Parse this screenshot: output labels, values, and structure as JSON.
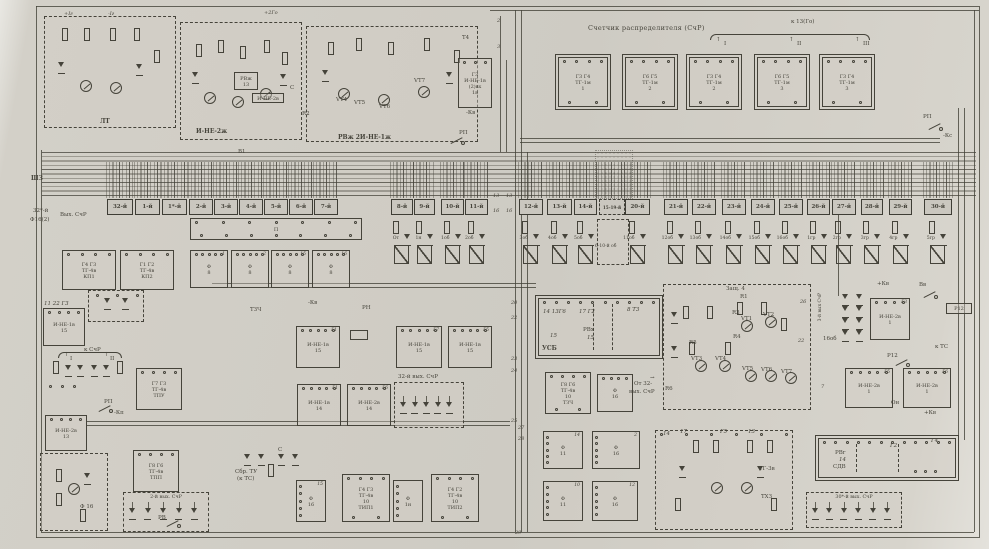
{
  "colors": {
    "paper": "#d0cdc5",
    "ink": "#45433a",
    "cell_fill": "#cac7bf"
  },
  "header": {
    "title": "Счетчик распределителя (СчР)",
    "to13": "к 13(Го)",
    "arrows": [
      "I",
      "II",
      "III"
    ]
  },
  "bus": {
    "label": "ШЗ"
  },
  "tg_row": [
    {
      "top": "Г3 Г4",
      "mid": "ТГ-1м",
      "num": "1"
    },
    {
      "top": "Г6 Г5",
      "mid": "ТГ-1м",
      "num": "2"
    },
    {
      "top": "Г3 Г4",
      "mid": "ТГ-1м",
      "num": "2"
    },
    {
      "top": "Г6 Г5",
      "mid": "ТГ-1м",
      "num": "3"
    },
    {
      "top": "Г3 Г4",
      "mid": "ТГ-1м",
      "num": "3"
    }
  ],
  "cells": [
    [
      "32-й",
      107,
      26
    ],
    [
      "1-й",
      135,
      25
    ],
    [
      "1*-й",
      162,
      25
    ],
    [
      "2-й",
      189,
      24
    ],
    [
      "3-й",
      214,
      24
    ],
    [
      "4-й",
      239,
      24
    ],
    [
      "5-й",
      264,
      24
    ],
    [
      "6-й",
      289,
      24
    ],
    [
      "7-й",
      314,
      24
    ],
    [
      "8-й",
      391,
      22
    ],
    [
      "9-й",
      414,
      21
    ],
    [
      "10-й",
      441,
      23
    ],
    [
      "11-й",
      465,
      23
    ],
    [
      "12-й",
      519,
      24
    ],
    [
      "13-й",
      547,
      25
    ],
    [
      "14-й",
      574,
      23
    ],
    [
      "15-19-й",
      599,
      26,
      "dash"
    ],
    [
      "20-й",
      625,
      25
    ],
    [
      "21-й",
      664,
      24
    ],
    [
      "22-й",
      692,
      24
    ],
    [
      "23-й",
      722,
      24
    ],
    [
      "24-й",
      751,
      24
    ],
    [
      "25-й",
      779,
      24
    ],
    [
      "26-й",
      807,
      23
    ],
    [
      "27-й",
      832,
      24
    ],
    [
      "28-й",
      861,
      22
    ],
    [
      "29-й",
      889,
      23
    ],
    [
      "30-й",
      924,
      28
    ]
  ],
  "contacts": [
    "От",
    "1н",
    "1об",
    "2об",
    "3об",
    "4об",
    "5об",
    "11об",
    "12об",
    "13об",
    "14об",
    "15об",
    "16об",
    "1гр",
    "2гр",
    "3гр",
    "4гр",
    "5гр"
  ],
  "contact_gap_label": "6-10-й об",
  "blocks": [
    {
      "id": "lt",
      "x": 44,
      "y": 16,
      "w": 132,
      "h": 112,
      "st": "dd",
      "deco": "analog2"
    },
    {
      "id": "i-ne-2zh",
      "x": 180,
      "y": 22,
      "w": 122,
      "h": 118,
      "st": "d",
      "deco": "analog3"
    },
    {
      "id": "rvzh",
      "x": 306,
      "y": 26,
      "w": 172,
      "h": 116,
      "st": "d",
      "deco": "analog3b"
    },
    {
      "id": "rvzh-13",
      "x": 234,
      "y": 72,
      "w": 24,
      "h": 18,
      "st": "s",
      "lines": [
        "РВж",
        "13"
      ]
    },
    {
      "id": "i-ne-2v-sm",
      "x": 252,
      "y": 93,
      "w": 32,
      "h": 10,
      "st": "s",
      "lines": [
        "И-НЕ-2в"
      ]
    },
    {
      "id": "i-ne-1v-1v",
      "x": 458,
      "y": 58,
      "w": 34,
      "h": 50,
      "st": "s",
      "pt": 3,
      "lines": [
        "Г3",
        "И-НЕ-1в",
        "(2)вх",
        "1в"
      ]
    },
    {
      "id": "tg-1",
      "x": 558,
      "y": 57,
      "w": 50,
      "h": 50,
      "st": "s",
      "dbl": 1,
      "pt": 4,
      "pb": 2,
      "lines": [
        "Г3 Г4",
        "ТГ-1м",
        "1"
      ]
    },
    {
      "id": "tg-2",
      "x": 625,
      "y": 57,
      "w": 50,
      "h": 50,
      "st": "s",
      "dbl": 1,
      "pt": 4,
      "pb": 2,
      "lines": [
        "Г6 Г5",
        "ТГ-1м",
        "2"
      ]
    },
    {
      "id": "tg-3",
      "x": 689,
      "y": 57,
      "w": 50,
      "h": 50,
      "st": "s",
      "dbl": 1,
      "pt": 4,
      "pb": 2,
      "lines": [
        "Г3 Г4",
        "ТГ-1м",
        "2"
      ]
    },
    {
      "id": "tg-4",
      "x": 757,
      "y": 57,
      "w": 50,
      "h": 50,
      "st": "s",
      "dbl": 1,
      "pt": 4,
      "pb": 2,
      "lines": [
        "Г6 Г5",
        "ТГ-1м",
        "3"
      ]
    },
    {
      "id": "tg-5",
      "x": 822,
      "y": 57,
      "w": 50,
      "h": 50,
      "st": "s",
      "dbl": 1,
      "pt": 4,
      "pb": 2,
      "lines": [
        "Г3 Г4",
        "ТГ-1м",
        "3"
      ]
    },
    {
      "id": "p-box",
      "x": 190,
      "y": 218,
      "w": 172,
      "h": 22,
      "st": "s",
      "pt": 7,
      "pb": 7,
      "lines": [
        "П"
      ]
    },
    {
      "id": "kp1",
      "x": 62,
      "y": 250,
      "w": 54,
      "h": 40,
      "st": "s",
      "pt": 4,
      "lines": [
        "Г4 Г3",
        "ТГ-4в",
        "КП1"
      ]
    },
    {
      "id": "kp2",
      "x": 120,
      "y": 250,
      "w": 54,
      "h": 40,
      "st": "s",
      "pt": 4,
      "lines": [
        "Г1 Г2",
        "ТГ-4в",
        "КП2"
      ]
    },
    {
      "id": "f8-1",
      "x": 190,
      "y": 250,
      "w": 38,
      "h": 38,
      "st": "s",
      "pt": 5,
      "lines": [
        "Ф",
        "8"
      ],
      "corner": "1"
    },
    {
      "id": "f8-2",
      "x": 231,
      "y": 250,
      "w": 38,
      "h": 38,
      "st": "s",
      "pt": 5,
      "lines": [
        "Ф",
        "8"
      ],
      "corner": "2"
    },
    {
      "id": "f8-3",
      "x": 271,
      "y": 250,
      "w": 38,
      "h": 38,
      "st": "s",
      "pt": 5,
      "lines": [
        "Ф",
        "8"
      ],
      "corner": "15"
    },
    {
      "id": "f8-4",
      "x": 312,
      "y": 250,
      "w": 38,
      "h": 38,
      "st": "s",
      "pt": 5,
      "lines": [
        "Ф",
        "8"
      ],
      "corner": "16"
    },
    {
      "id": "i-ne-1v-15L",
      "x": 43,
      "y": 308,
      "w": 42,
      "h": 38,
      "st": "s",
      "pt": 4,
      "lines": [
        "И-НЕ-1в",
        "15"
      ]
    },
    {
      "id": "diode-box",
      "x": 88,
      "y": 290,
      "w": 56,
      "h": 32,
      "st": "d",
      "deco": "diodes2"
    },
    {
      "id": "net1",
      "x": 45,
      "y": 355,
      "w": 88,
      "h": 48,
      "st": "n",
      "deco": "net1"
    },
    {
      "id": "tpu",
      "x": 136,
      "y": 368,
      "w": 46,
      "h": 42,
      "st": "s",
      "pt": 4,
      "lines": [
        "Г7 Г3",
        "ТГ-4в",
        "ТПУ"
      ]
    },
    {
      "id": "i-ne-2v-13",
      "x": 45,
      "y": 415,
      "w": 42,
      "h": 36,
      "st": "s",
      "pt": 4,
      "lines": [
        "И-НЕ-2в",
        "13"
      ]
    },
    {
      "id": "f16-dash",
      "x": 40,
      "y": 453,
      "w": 68,
      "h": 78,
      "st": "d",
      "deco": "analog1"
    },
    {
      "id": "tpp",
      "x": 133,
      "y": 450,
      "w": 46,
      "h": 42,
      "st": "s",
      "pt": 4,
      "lines": [
        "Г8 Г6",
        "ТГ-4в",
        "ТПП"
      ]
    },
    {
      "id": "out2",
      "x": 123,
      "y": 492,
      "w": 86,
      "h": 40,
      "st": "d",
      "cap_in": "2-й вых. СчР",
      "diodes": 5
    },
    {
      "id": "i-ne-1v-15a",
      "x": 296,
      "y": 326,
      "w": 44,
      "h": 42,
      "st": "s",
      "pt": 5,
      "corner": "Г1",
      "lines": [
        "И-НЕ-1в",
        "15"
      ]
    },
    {
      "id": "rn-coil",
      "x": 350,
      "y": 330,
      "w": 18,
      "h": 10,
      "st": "s"
    },
    {
      "id": "i-ne-1v-15b",
      "x": 396,
      "y": 326,
      "w": 46,
      "h": 42,
      "st": "s",
      "pt": 5,
      "corner": "Г7",
      "lines": [
        "И-НЕ-1в",
        "15"
      ]
    },
    {
      "id": "i-ne-1v-15c",
      "x": 448,
      "y": 326,
      "w": 44,
      "h": 42,
      "st": "s",
      "pt": 5,
      "corner": "Г5",
      "lines": [
        "И-НЕ-1в",
        "15"
      ]
    },
    {
      "id": "i-ne-1v-14",
      "x": 297,
      "y": 384,
      "w": 44,
      "h": 42,
      "st": "s",
      "pt": 5,
      "corner": "Г1",
      "lines": [
        "И-НЕ-1в",
        "14"
      ]
    },
    {
      "id": "i-ne-2v-14",
      "x": 347,
      "y": 384,
      "w": 44,
      "h": 42,
      "st": "s",
      "pt": 5,
      "corner": "Г6",
      "lines": [
        "И-НЕ-2в",
        "14"
      ]
    },
    {
      "id": "out32",
      "x": 394,
      "y": 382,
      "w": 70,
      "h": 46,
      "st": "d",
      "cap": "32-й вых. СчР",
      "diodes": 5
    },
    {
      "id": "usb",
      "x": 538,
      "y": 298,
      "w": 122,
      "h": 58,
      "st": "s",
      "dbl": 1,
      "pt": 10,
      "deco": "usb"
    },
    {
      "id": "tzch-10",
      "x": 545,
      "y": 372,
      "w": 46,
      "h": 42,
      "st": "s",
      "pt": 4,
      "pb": 2,
      "lines": [
        "Г8 Г6",
        "ТГ-4в",
        "10",
        "ТЗЧ"
      ]
    },
    {
      "id": "f16-a",
      "x": 597,
      "y": 374,
      "w": 36,
      "h": 38,
      "st": "s",
      "pt": 4,
      "lines": [
        "Ф",
        "16"
      ]
    },
    {
      "id": "zasch-4",
      "x": 663,
      "y": 284,
      "w": 148,
      "h": 126,
      "st": "d",
      "deco": "zasch"
    },
    {
      "id": "d-cluster",
      "x": 836,
      "y": 292,
      "w": 34,
      "h": 52,
      "st": "n",
      "deco": "dclust"
    },
    {
      "id": "i-ne-2v-1a",
      "x": 870,
      "y": 298,
      "w": 40,
      "h": 42,
      "st": "s",
      "pt": 4,
      "corner": "Г3",
      "lines": [
        "И-НЕ-2в",
        "1"
      ]
    },
    {
      "id": "r12-coil",
      "x": 946,
      "y": 303,
      "w": 26,
      "h": 11,
      "st": "s",
      "lines": [
        "Р12"
      ]
    },
    {
      "id": "i-ne-2v-1b",
      "x": 845,
      "y": 368,
      "w": 48,
      "h": 40,
      "st": "s",
      "pt": 5,
      "corner": "Г5",
      "lines": [
        "И-НЕ-2в",
        "1"
      ]
    },
    {
      "id": "i-ne-2v-1c",
      "x": 903,
      "y": 368,
      "w": 48,
      "h": 40,
      "st": "s",
      "pt": 5,
      "corner": "Г6",
      "lines": [
        "И-НЕ-2в",
        "1"
      ]
    },
    {
      "id": "net2",
      "x": 238,
      "y": 448,
      "w": 62,
      "h": 30,
      "st": "n",
      "deco": "net2"
    },
    {
      "id": "f16-b",
      "x": 296,
      "y": 480,
      "w": 30,
      "h": 42,
      "st": "s",
      "pl": 5,
      "lines": [
        "Ф",
        "16"
      ],
      "corner": "15"
    },
    {
      "id": "tip1",
      "x": 342,
      "y": 474,
      "w": 48,
      "h": 48,
      "st": "s",
      "pt": 4,
      "pb": 2,
      "lines": [
        "Г4 Г3",
        "ТГ-4в",
        "10",
        "ТИП1"
      ]
    },
    {
      "id": "f1n",
      "x": 393,
      "y": 480,
      "w": 30,
      "h": 42,
      "st": "s",
      "pl": 5,
      "lines": [
        "Ф",
        "1н"
      ]
    },
    {
      "id": "tip2",
      "x": 431,
      "y": 474,
      "w": 48,
      "h": 48,
      "st": "s",
      "pt": 4,
      "pb": 2,
      "lines": [
        "Г4 Г2",
        "ТГ-4в",
        "10",
        "ТИП2"
      ]
    },
    {
      "id": "f11-a",
      "x": 543,
      "y": 431,
      "w": 40,
      "h": 38,
      "st": "s",
      "pl": 5,
      "lines": [
        "Ф",
        "11"
      ],
      "corner": "14"
    },
    {
      "id": "f16-c",
      "x": 592,
      "y": 431,
      "w": 48,
      "h": 38,
      "st": "s",
      "pl": 5,
      "lines": [
        "Ф",
        "16"
      ],
      "corner": "2"
    },
    {
      "id": "f11-b",
      "x": 543,
      "y": 481,
      "w": 40,
      "h": 40,
      "st": "s",
      "pl": 5,
      "lines": [
        "Ф",
        "11"
      ],
      "corner": "10"
    },
    {
      "id": "f16-d",
      "x": 592,
      "y": 481,
      "w": 46,
      "h": 40,
      "st": "s",
      "pl": 5,
      "lines": [
        "Ф",
        "16"
      ],
      "corner": "12"
    },
    {
      "id": "txz",
      "x": 655,
      "y": 430,
      "w": 138,
      "h": 100,
      "st": "d",
      "pt": 6,
      "deco": "txz"
    },
    {
      "id": "rvg",
      "x": 818,
      "y": 438,
      "w": 138,
      "h": 40,
      "st": "s",
      "dbl": 1,
      "pt": 12,
      "deco": "rvg"
    },
    {
      "id": "out30",
      "x": 806,
      "y": 492,
      "w": 96,
      "h": 36,
      "st": "d",
      "cap_in": "30*-й вых. СчР",
      "diodes": 6
    }
  ],
  "labels": [
    [
      "+Iг",
      64,
      11,
      "wn"
    ],
    [
      "-Iг",
      108,
      11,
      "wn"
    ],
    [
      "+2Го",
      264,
      10,
      "wn"
    ],
    [
      "ЛТ",
      100,
      119,
      "b"
    ],
    [
      "И-НЕ-2ж",
      196,
      129,
      "b"
    ],
    [
      "В1",
      238,
      149
    ],
    [
      "РВж  2И-НЕ-1ж",
      338,
      135,
      "b"
    ],
    [
      "С",
      290,
      85
    ],
    [
      "R2",
      302,
      111
    ],
    [
      "VT4",
      336,
      97
    ],
    [
      "VT5",
      354,
      100
    ],
    [
      "VT6",
      379,
      104
    ],
    [
      "VT7",
      414,
      78
    ],
    [
      "Т4",
      462,
      35
    ],
    [
      "-Кв",
      466,
      110
    ],
    [
      "РП",
      459,
      130
    ],
    [
      "↑",
      716,
      37
    ],
    [
      "I",
      724,
      41
    ],
    [
      "↑",
      789,
      37
    ],
    [
      "II",
      797,
      41
    ],
    [
      "↑",
      855,
      37
    ],
    [
      "III",
      863,
      41
    ],
    [
      "РП",
      923,
      114
    ],
    [
      "-Кс",
      943,
      133
    ],
    [
      "32*-й",
      33,
      208
    ],
    [
      "Ф16(2)",
      30,
      217
    ],
    [
      "Вых. СчР",
      60,
      212
    ],
    [
      "11 22 Г3",
      44,
      301,
      "i"
    ],
    [
      "ТЗЧ",
      250,
      307
    ],
    [
      "-Кв",
      308,
      300
    ],
    [
      "РН",
      362,
      305
    ],
    [
      "к СчР",
      84,
      347
    ],
    [
      "↑",
      64,
      352
    ],
    [
      "I",
      70,
      356
    ],
    [
      "↑",
      104,
      352
    ],
    [
      "II",
      110,
      356
    ],
    [
      "РП",
      104,
      399
    ],
    [
      "-Кп",
      114,
      410
    ],
    [
      "Ф 16",
      80,
      504
    ],
    [
      "РВ",
      158,
      515
    ],
    [
      "От 32-",
      634,
      381
    ],
    [
      "вых. СчР",
      629,
      389
    ],
    [
      "→",
      650,
      375
    ],
    [
      "УСБ",
      542,
      346,
      "b"
    ],
    [
      "14 13Г6",
      543,
      309,
      "i"
    ],
    [
      "17 Г2",
      579,
      309,
      "i"
    ],
    [
      "8 Т3",
      627,
      307,
      "i"
    ],
    [
      "15",
      550,
      333,
      "i"
    ],
    [
      "РВх",
      583,
      327
    ],
    [
      "15",
      587,
      335,
      "i"
    ],
    [
      "Защ. 4",
      726,
      286
    ],
    [
      "R1",
      740,
      294
    ],
    [
      "R3",
      732,
      310
    ],
    [
      "VT1",
      741,
      316
    ],
    [
      "VT2",
      763,
      312
    ],
    [
      "R4",
      733,
      334
    ],
    [
      "R5",
      689,
      340
    ],
    [
      "VT3",
      691,
      356
    ],
    [
      "VT4",
      715,
      356
    ],
    [
      "R6",
      665,
      386
    ],
    [
      "VT5",
      742,
      366
    ],
    [
      "VT6",
      761,
      367
    ],
    [
      "VT7",
      781,
      369
    ],
    [
      "3-й вых СчР",
      818,
      293,
      "v"
    ],
    [
      "16об",
      823,
      336
    ],
    [
      "+Кв",
      877,
      281
    ],
    [
      "Вв",
      919,
      282
    ],
    [
      "к ТС",
      935,
      344
    ],
    [
      "Р12",
      887,
      353
    ],
    [
      "Он",
      891,
      400
    ],
    [
      "+Кв",
      924,
      410
    ],
    [
      "Сбр. ТУ",
      235,
      469
    ],
    [
      "(к ТС)",
      237,
      476
    ],
    [
      "С",
      278,
      447
    ],
    [
      "14",
      663,
      431,
      "i"
    ],
    [
      "17",
      680,
      429,
      "i"
    ],
    [
      "Г5",
      720,
      429,
      "i"
    ],
    [
      "13",
      748,
      429,
      "i"
    ],
    [
      "ТГ-3в",
      759,
      466
    ],
    [
      "ТХЗ",
      761,
      494
    ],
    [
      "Г2",
      890,
      443,
      "i"
    ],
    [
      "Г4",
      931,
      438,
      "i"
    ],
    [
      "РВг",
      835,
      450
    ],
    [
      "14",
      839,
      457,
      "i"
    ],
    [
      "СДВ",
      833,
      464
    ]
  ],
  "wire_numbers": [
    [
      "2",
      497,
      18
    ],
    [
      "3",
      497,
      44
    ],
    [
      "13",
      493,
      193
    ],
    [
      "13",
      506,
      193
    ],
    [
      "16",
      493,
      208
    ],
    [
      "16",
      506,
      208
    ],
    [
      "20",
      511,
      300
    ],
    [
      "22",
      511,
      315
    ],
    [
      "23",
      511,
      356
    ],
    [
      "24",
      511,
      368
    ],
    [
      "25",
      511,
      418
    ],
    [
      "27",
      518,
      425
    ],
    [
      "28",
      518,
      436
    ],
    [
      "26",
      800,
      299
    ],
    [
      "22",
      798,
      338
    ],
    [
      "7",
      821,
      384
    ],
    [
      "29",
      515,
      530
    ]
  ],
  "switches": [
    [
      450,
      136
    ],
    [
      928,
      122
    ],
    [
      98,
      404
    ],
    [
      923,
      290
    ],
    [
      895,
      358
    ],
    [
      166,
      519
    ]
  ],
  "braces": [
    [
      710,
      34,
      158
    ],
    [
      58,
      352,
      62
    ]
  ]
}
